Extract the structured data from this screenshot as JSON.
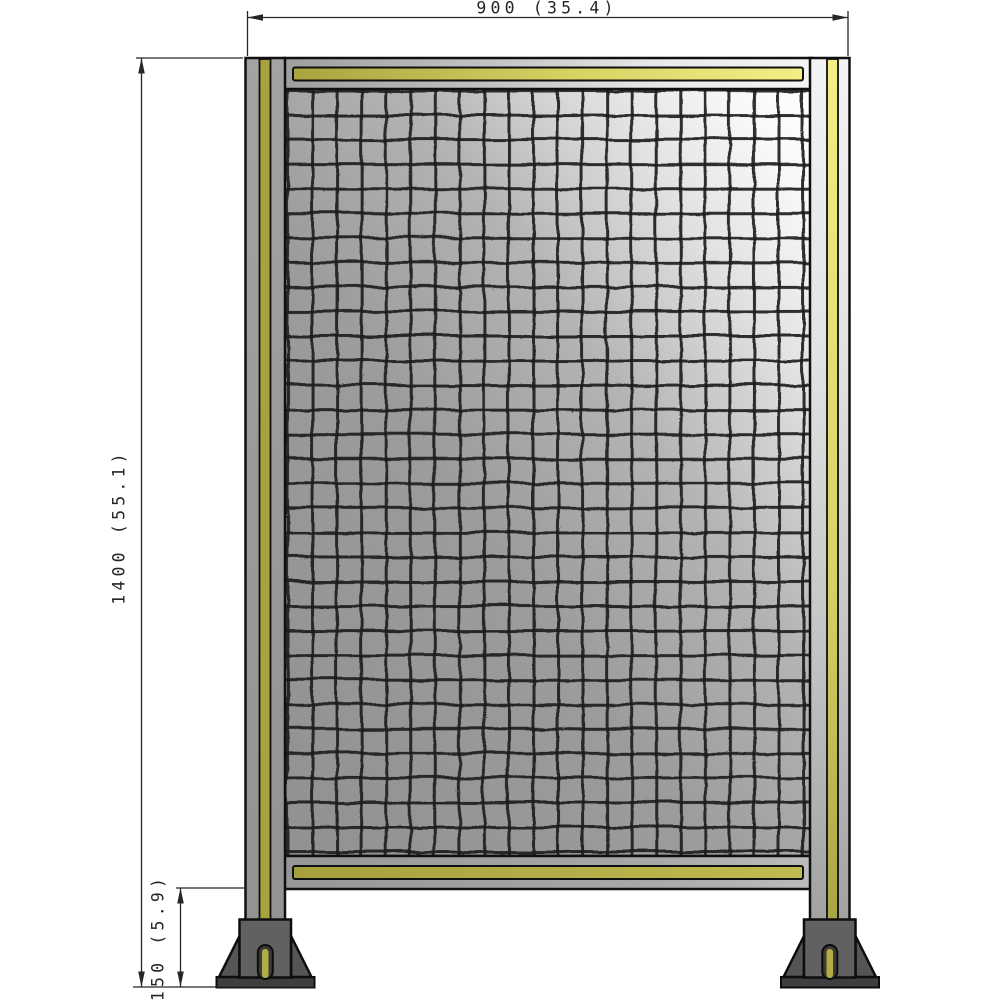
{
  "dimensions": {
    "width_label": "900 (35.4)",
    "height_label": "1400 (55.1)",
    "foot_height_label": "150 (5.9)"
  },
  "colors": {
    "line": "#262626",
    "stripe_olive": "#a8a33f",
    "stripe_yellow_light": "#f4ee86",
    "metal_gray": "#9b9b9b",
    "foot_body": "#616161",
    "foot_gusset": "#555555",
    "foot_base": "#3e3e3e",
    "foot_slot_yellow": "#b2ac46",
    "mesh_wire": "#1c1c1c"
  },
  "mesh": {
    "columns": 21,
    "rows": 31
  }
}
